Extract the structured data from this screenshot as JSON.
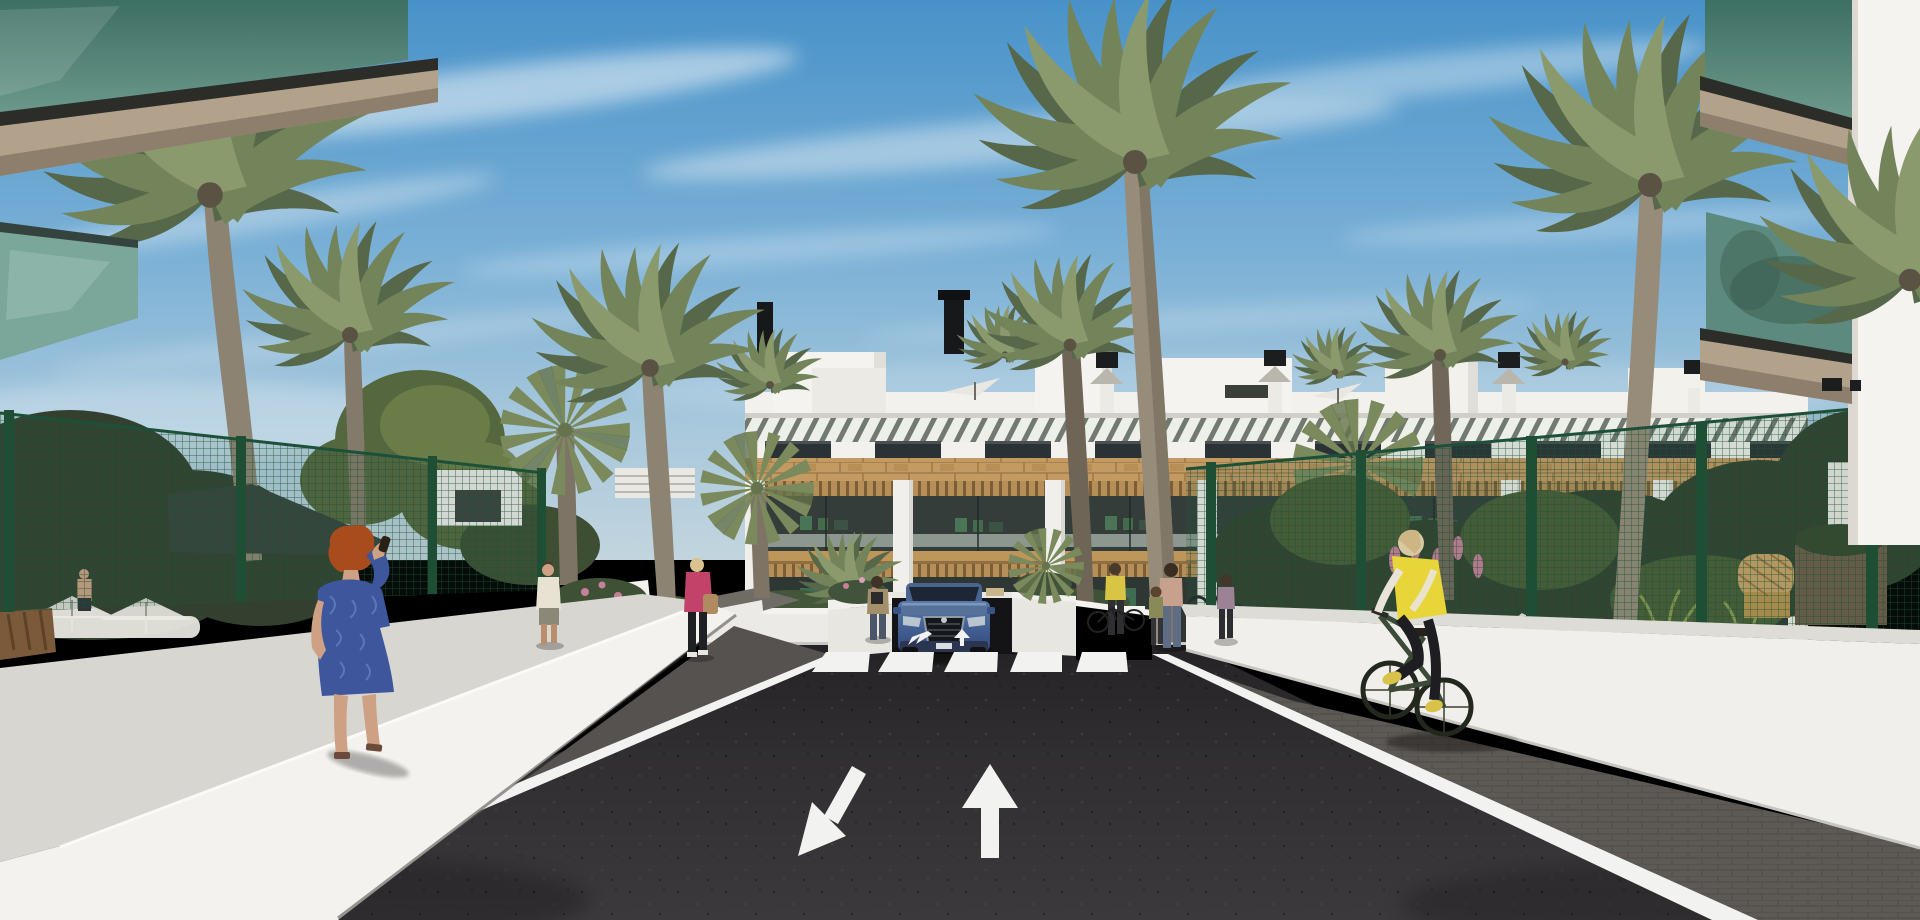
{
  "scene": {
    "title": "Mediterranean apartment complex — architectural 3D render",
    "description": "Computer-generated exterior rendering of a modern white two-storey apartment complex with wooden accents, rooftop solariums, palm trees, green mesh fences, landscaped gardens, a central asphalt driveway with a pedestrian crossing and directional arrows, a blue SUV at a garage ramp, pedestrians and a cyclist under a blue sky with wispy clouds.",
    "environment": {
      "sky": "blue with thin cirrus cloud streaks",
      "lighting": "bright sunlight from upper left",
      "vegetation": [
        "date palms",
        "fan palms",
        "hedges",
        "pink flowering shrubs",
        "orange flowerbed",
        "ornamental grasses"
      ]
    },
    "building": {
      "style": "modern Mediterranean residential block",
      "features": [
        "white parapet with penthouse boxes",
        "black chimney caps",
        "louvred slat band",
        "dark upper windows",
        "wood-clad band",
        "white pergola columns with timber slat roofs",
        "glass-railed terraces",
        "white planter walls",
        "rooftop parasols"
      ]
    },
    "foreground": {
      "left": "white walkway wall with woman on phone, green mesh fence, shade sail, pool umbrellas, wooden bench",
      "right": "white perimeter wall with green mesh fence, wicker armchair, brown planter, cyclist on paved strip",
      "corners": "glass-railed balconies with beige soffits of flanking buildings at top left and top right"
    },
    "road": {
      "surface": "dark asphalt",
      "markings": {
        "crosswalk_stripes": 5,
        "large_arrows": [
          "down-left toward viewer",
          "straight ahead"
        ],
        "small_arrows_near_crossing": 2,
        "edge_lines": "white on both sides"
      },
      "garage": "dark basement ramp entrance below the central building"
    },
    "vehicles": [
      {
        "type": "SUV",
        "color": "blue",
        "view": "front",
        "position": "at garage ramp, centre"
      },
      {
        "type": "bicycle",
        "color": "dark green",
        "position": "right paved strip"
      }
    ],
    "people": [
      {
        "id": "woman-on-phone",
        "hair": "red",
        "clothes": "blue patterned dress",
        "action": "walking on left wall, phone to ear"
      },
      {
        "id": "man-walking-away",
        "clothes": "white sleeveless top, grey shorts",
        "action": "walking on left path"
      },
      {
        "id": "woman-pink-jacket",
        "hair": "blonde",
        "clothes": "pink jacket, black trousers, tan handbag",
        "action": "walking left"
      },
      {
        "id": "woman-by-car",
        "clothes": "tan jacket, dark jeans",
        "action": "standing left of SUV"
      },
      {
        "id": "woman-yellow-top",
        "clothes": "yellow top, dark trousers",
        "action": "standing at bicycle racks"
      },
      {
        "id": "parent-and-child",
        "clothes": "floral top and jeans; child in olive top",
        "action": "standing together right of crossing"
      },
      {
        "id": "woman-walking-right",
        "clothes": "mauve top, dark skirt",
        "action": "walking near building"
      },
      {
        "id": "balcony-couple",
        "clothes": "blue shirt man, yellow top woman",
        "action": "standing on first-floor terrace"
      },
      {
        "id": "man-at-pool",
        "clothes": "shirtless, dark shorts",
        "action": "behind left fence"
      },
      {
        "id": "cyclist",
        "hair": "blonde",
        "clothes": "yellow gilet, white sleeves, black leggings, yellow shoes",
        "action": "riding right paved strip"
      }
    ]
  },
  "colors": {
    "sky_top": "#4892c9",
    "sky_mid": "#7ab0d6",
    "sky_low": "#aac9dc",
    "sky_horizon": "#c3d5de",
    "cloud": "#eef4f7",
    "building_white": "#f2f1ed",
    "building_shade": "#dddcd6",
    "slat_shadow": "#5d645a",
    "window_dark": "#2b3236",
    "wood": "#c49a63",
    "wood_dark": "#9e7a48",
    "terrace_dark": "#343d39",
    "glass_balcony": "#48756b",
    "soffit_tan": "#b3a28b",
    "soffit_dark": "#8d7f6c",
    "fence_green": "#2e5f43",
    "fence_post": "#1e4f35",
    "foliage_dark": "#2f3f2b",
    "foliage_mid": "#4a5c38",
    "foliage_light": "#67794a",
    "palm_back": "#57684a",
    "palm_front": "#73845b",
    "palm_highlight": "#8b9a6d",
    "trunk": "#8d8373",
    "road_dark": "#252325",
    "road_mid": "#312e31",
    "road_light": "#3c393c",
    "marking_white": "#f2f2f0",
    "pavement_grey": "#5d5955",
    "wall_white": "#f3f2ee",
    "wall_top": "#d7d6d1",
    "car_blue_light": "#5a7aab",
    "car_blue_dark": "#31497e",
    "car_glass": "#1d2635",
    "sail_dark": "#39433d",
    "dress_blue": "#3d569c",
    "jacket_pink": "#c2426a",
    "vest_yellow": "#e8d53a",
    "bag_tan": "#b08b5f",
    "flower_pink": "#c77f9b",
    "flower_orange": "#c8772f",
    "wicker": "#caa467",
    "planter_brown": "#6f5d4a",
    "hair_red": "#a84c1d"
  }
}
